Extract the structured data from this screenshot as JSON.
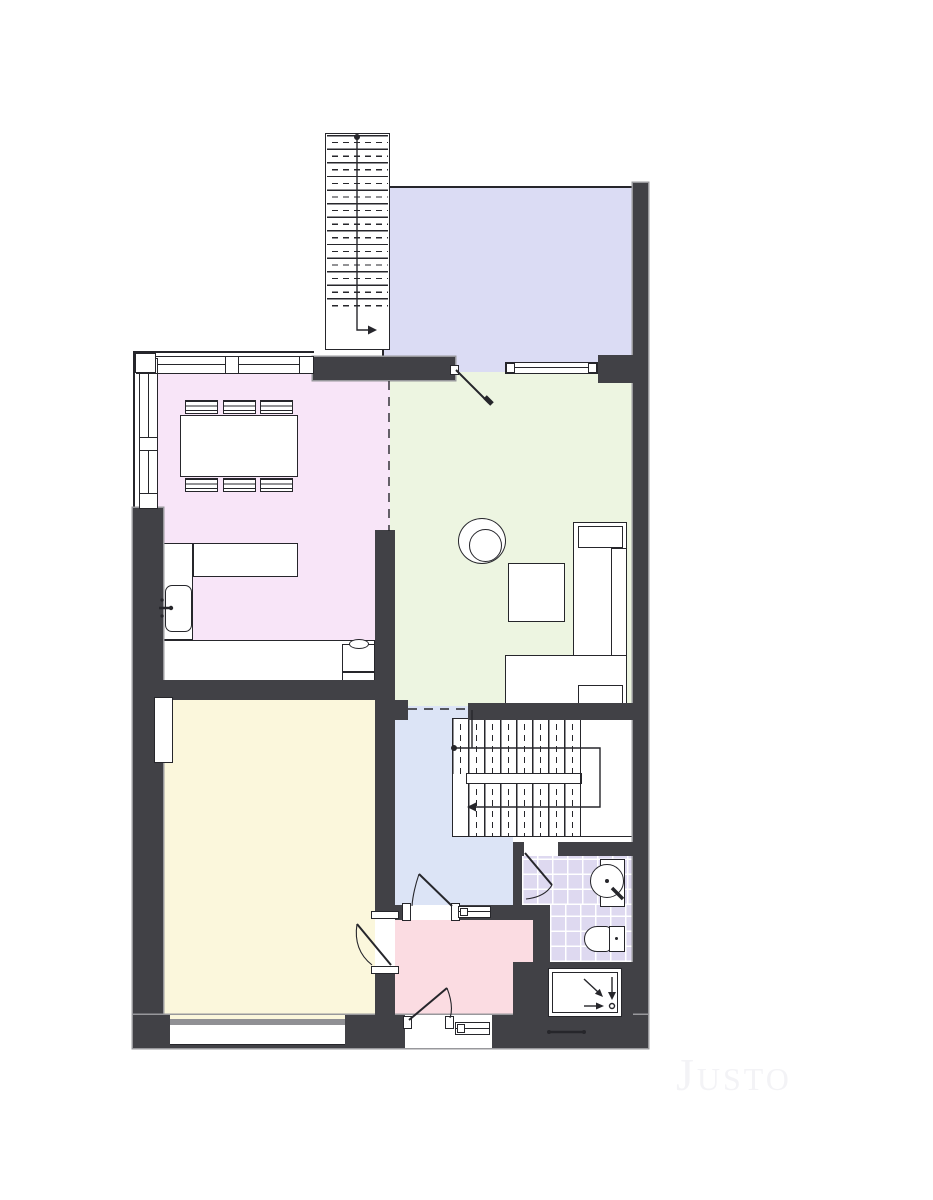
{
  "plan": {
    "type": "apartment-floor-plan",
    "watermark": "Justo",
    "rooms": [
      {
        "name": "terrace",
        "color_key": "terrace"
      },
      {
        "name": "kitchen-dining",
        "color_key": "kitchen"
      },
      {
        "name": "living-room",
        "color_key": "living"
      },
      {
        "name": "bedroom",
        "color_key": "bedroom"
      },
      {
        "name": "hallway",
        "color_key": "hallway"
      },
      {
        "name": "bathroom",
        "color_key": "bathroom"
      },
      {
        "name": "entry-hall",
        "color_key": "entry"
      }
    ],
    "fixtures": [
      "exterior-staircase",
      "interior-staircase",
      "dining-table",
      "dining-chairs",
      "kitchen-counter",
      "kitchen-island",
      "kitchen-sink",
      "cooktop",
      "armchair",
      "coffee-table",
      "corner-sofa",
      "washbasin",
      "toilet",
      "shower-tray",
      "doors",
      "windows"
    ]
  },
  "colors": {
    "background": "#ffffff",
    "wall": "#414146",
    "wall_edge": "#98989c",
    "line": "#26262b",
    "terrace": "#dbdcf4",
    "kitchen": "#f8e5f8",
    "living": "#edf5e1",
    "bedroom": "#fbf7dc",
    "hallway": "#dce4f6",
    "bathroom": "#ded9f0",
    "grout": "#ffffff",
    "entry": "#fbdce2",
    "fixture": "#ffffff",
    "watermark": "#f3f3f6",
    "window_band": "#909094"
  }
}
